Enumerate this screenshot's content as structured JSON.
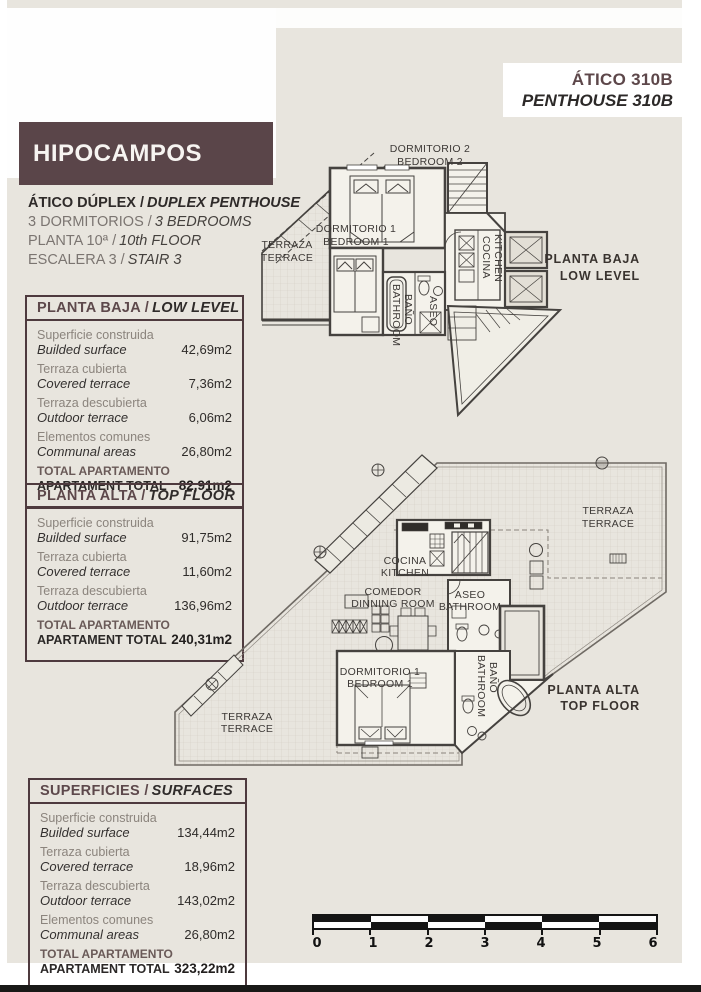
{
  "colors": {
    "brand_brown": "#5a4549",
    "page_beige": "#e8e5de",
    "table_border": "#4e3a3e",
    "ink": "#2e2a29"
  },
  "header": {
    "unit_es": "ÁTICO 310B",
    "unit_en": "PENTHOUSE 310B",
    "project": "HIPOCAMPOS",
    "lines": [
      {
        "es": "ÁTICO DÚPLEX /",
        "en": "DUPLEX PENTHOUSE"
      },
      {
        "es": "3 DORMITORIOS /",
        "en": "3 BEDROOMS"
      },
      {
        "es": "PLANTA 10ª /",
        "en": "10th FLOOR"
      },
      {
        "es": "ESCALERA 3 /",
        "en": "STAIR 3"
      }
    ]
  },
  "tables": {
    "low": {
      "title_es": "PLANTA BAJA /",
      "title_en": "LOW LEVEL",
      "rows": [
        {
          "label_es": "Superficie construida",
          "label_en": "Builded surface",
          "value": "42,69m2"
        },
        {
          "label_es": "Terraza cubierta",
          "label_en": "Covered terrace",
          "value": "7,36m2"
        },
        {
          "label_es": "Terraza descubierta",
          "label_en": "Outdoor terrace",
          "value": "6,06m2"
        },
        {
          "label_es": "Elementos comunes",
          "label_en": "Communal areas",
          "value": "26,80m2"
        }
      ],
      "total": {
        "label_es": "TOTAL APARTAMENTO",
        "label_en": "APARTAMENT TOTAL",
        "value": "82,91m2"
      }
    },
    "top": {
      "title_es": "PLANTA ALTA /",
      "title_en": "TOP FLOOR",
      "rows": [
        {
          "label_es": "Superficie construida",
          "label_en": "Builded surface",
          "value": "91,75m2"
        },
        {
          "label_es": "Terraza cubierta",
          "label_en": "Covered terrace",
          "value": "11,60m2"
        },
        {
          "label_es": "Terraza descubierta",
          "label_en": "Outdoor terrace",
          "value": "136,96m2"
        }
      ],
      "total": {
        "label_es": "TOTAL APARTAMENTO",
        "label_en": "APARTAMENT TOTAL",
        "value": "240,31m2"
      }
    },
    "all": {
      "title_es": "SUPERFICIES /",
      "title_en": "SURFACES",
      "rows": [
        {
          "label_es": "Superficie construida",
          "label_en": "Builded surface",
          "value": "134,44m2"
        },
        {
          "label_es": "Terraza cubierta",
          "label_en": "Covered terrace",
          "value": "18,96m2"
        },
        {
          "label_es": "Terraza descubierta",
          "label_en": "Outdoor terrace",
          "value": "143,02m2"
        },
        {
          "label_es": "Elementos comunes",
          "label_en": "Communal areas",
          "value": "26,80m2"
        }
      ],
      "total": {
        "label_es": "TOTAL APARTAMENTO",
        "label_en": "APARTAMENT TOTAL",
        "value": "323,22m2"
      }
    }
  },
  "plans": {
    "low": {
      "bedroom2_es": "DORMITORIO 2",
      "bedroom2_en": "BEDROOM 2",
      "terrace_es": "TERRAZA",
      "terrace_en": "TERRACE",
      "bedroom1_es": "DORMITORIO 1",
      "bedroom1_en": "BEDROOM 1",
      "kitchen_es": "COCINA",
      "kitchen_en": "KITCHEN",
      "bath_es": "BAÑO",
      "bath_en": "BATHROOM",
      "aseo_es": "ASEO",
      "tag_es": "PLANTA BAJA",
      "tag_en": "LOW LEVEL"
    },
    "top": {
      "terrace_right_es": "TERRAZA",
      "terrace_right_en": "TERRACE",
      "kitchen_es": "COCINA",
      "kitchen_en": "KITCHEN",
      "dining_es": "COMEDOR",
      "dining_en": "DINNING ROOM",
      "aseo_es": "ASEO",
      "aseo_en": "BATHROOM",
      "bedroom1_es": "DORMITORIO 1",
      "bedroom1_en": "BEDROOM 1",
      "bath_es": "BAÑO",
      "bath_en": "BATHROOM",
      "terrace_left_es": "TERRAZA",
      "terrace_left_en": "TERRACE",
      "tag_es": "PLANTA ALTA",
      "tag_en": "TOP FLOOR"
    }
  },
  "scale": {
    "ticks": [
      "0",
      "1",
      "2",
      "3",
      "4",
      "5",
      "6"
    ]
  }
}
